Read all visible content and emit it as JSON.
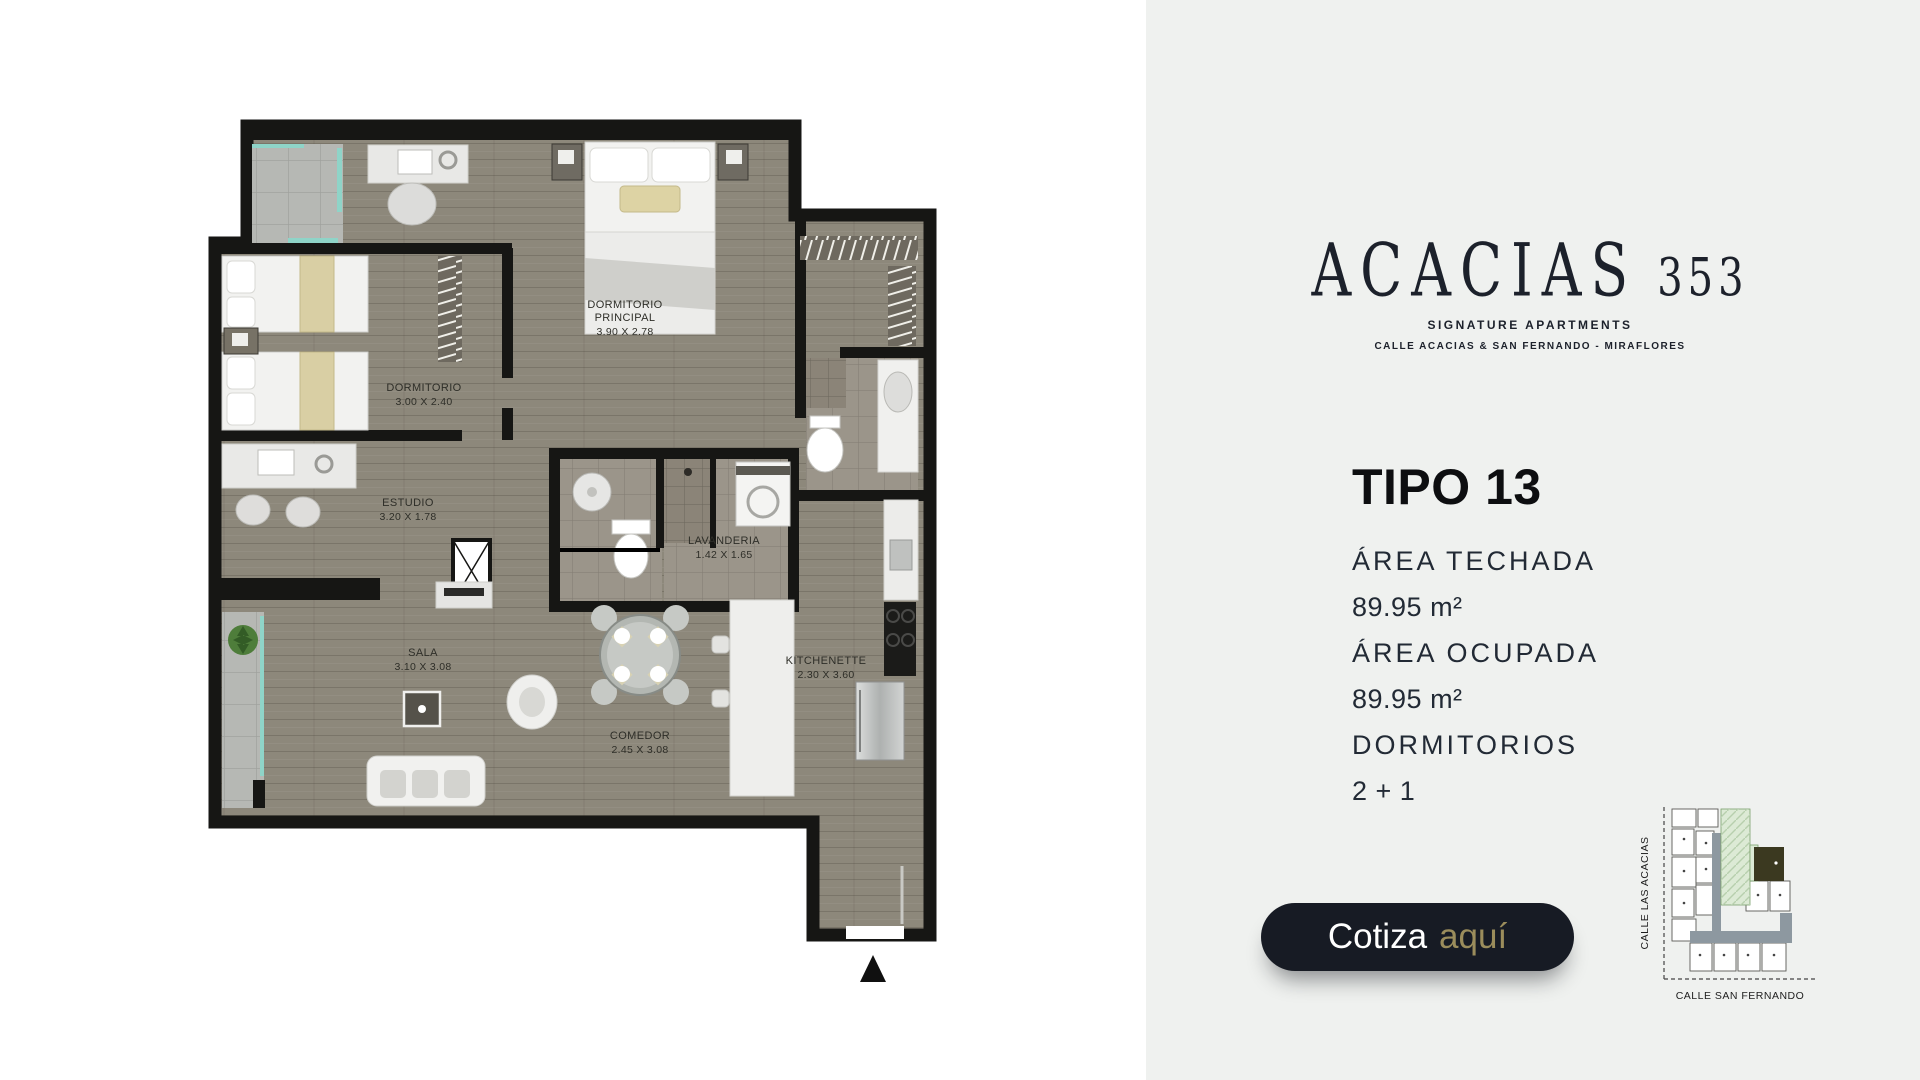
{
  "brand": {
    "name": "ACACIAS",
    "number": "353",
    "tagline": "SIGNATURE APARTMENTS",
    "address": "CALLE ACACIAS & SAN FERNANDO - MIRAFLORES"
  },
  "unit": {
    "title": "TIPO 13",
    "specs": [
      {
        "label": "ÁREA TECHADA",
        "value": "89.95 m²"
      },
      {
        "label": "ÁREA OCUPADA",
        "value": "89.95 m²"
      },
      {
        "label": "DORMITORIOS",
        "value": "2 + 1"
      }
    ]
  },
  "cta": {
    "text_primary": "Cotiza",
    "text_accent": "aquí"
  },
  "map": {
    "street_left": "CALLE LAS ACACIAS",
    "street_bottom": "CALLE SAN FERNANDO",
    "highlight_unit_color": "#3b3920",
    "building_footprint_color": "#dcead5",
    "corridor_color": "#8d98a0"
  },
  "plan": {
    "entry_marker_icon": "triangle-up-icon",
    "rooms": [
      {
        "name": "DORMITORIO",
        "name2": "PRINCIPAL",
        "dims": "3.90 X 2.78"
      },
      {
        "name": "DORMITORIO",
        "dims": "3.00 X 2.40"
      },
      {
        "name": "ESTUDIO",
        "dims": "3.20 X 1.78"
      },
      {
        "name": "SALA",
        "dims": "3.10 X 3.08"
      },
      {
        "name": "COMEDOR",
        "dims": "2.45 X 3.08"
      },
      {
        "name": "LAVANDERIA",
        "dims": "1.42 X 1.65"
      },
      {
        "name": "KITCHENETTE",
        "dims": "2.30 X 3.60"
      }
    ]
  },
  "colors": {
    "panel_bg": "#eff1ef",
    "cta_bg": "#171b24",
    "cta_accent": "#9b8d5c",
    "text_dark": "#1c212b",
    "wall": "#161614",
    "wood_floor": "#8d887b",
    "glass_teal": "#8fd4c8"
  }
}
